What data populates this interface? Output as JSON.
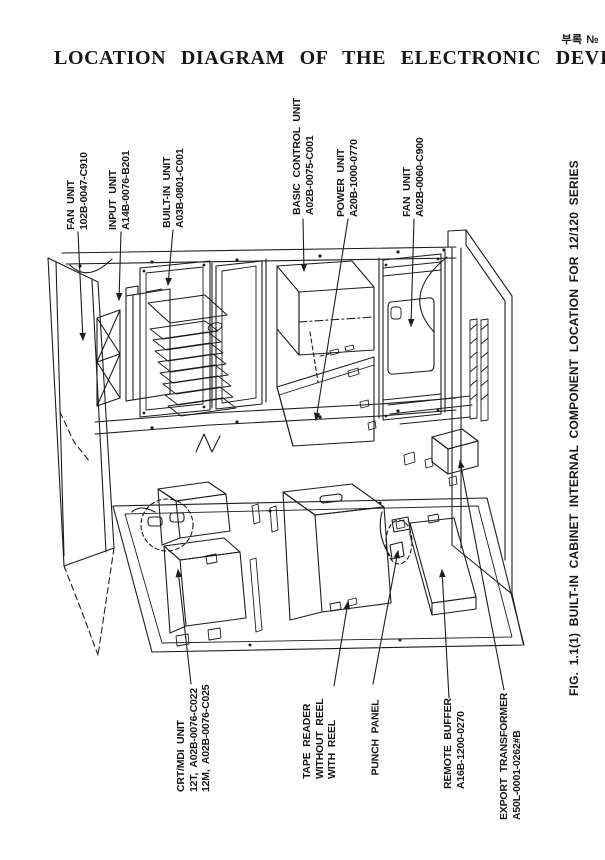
{
  "page": {
    "title": "LOCATION DIAGRAM OF THE ELECTRONIC DEVICES",
    "corner_note": "부록 №"
  },
  "figure": {
    "caption": "FIG. 1.1(1) BUILT-IN CABINET INTERNAL COMPONENT LOCATION FOR 12/120 SERIES"
  },
  "component_labels": {
    "fan_unit_top": {
      "name": "FAN UNIT",
      "part": "102B-0047-C910"
    },
    "input_unit": {
      "name": "INPUT UNIT",
      "part": "A14B-0076-B201"
    },
    "built_in_unit": {
      "name": "BUILT-IN UNIT",
      "part": "A03B-0801-C001"
    },
    "basic_control_unit": {
      "name": "BASIC CONTROL UNIT",
      "part": "A02B-0075-C001"
    },
    "power_unit": {
      "name": "POWER UNIT",
      "part": "A20B-1000-0770"
    },
    "fan_unit_right": {
      "name": "FAN UNIT",
      "part": "A02B-0060-C900"
    },
    "crt_mdi_unit": {
      "name": "CRT/MDI UNIT",
      "part_line1": "12T, A02B-0076-C022",
      "part_line2": "12M, A02B-0076-C025"
    },
    "tape_reader": {
      "name": "TAPE READER",
      "variant1": "WITHOUT REEL",
      "variant2": "WITH REEL"
    },
    "punch_panel": {
      "name": "PUNCH PANEL"
    },
    "remote_buffer": {
      "name": "REMOTE BUFFER",
      "part": "A16B-1200-0270"
    },
    "export_transformer": {
      "name": "EXPORT TRANSFORMER",
      "part": "A50L-0001-0262#B"
    }
  },
  "colors": {
    "ink": "#1c1c1c",
    "paper": "#ffffff"
  }
}
